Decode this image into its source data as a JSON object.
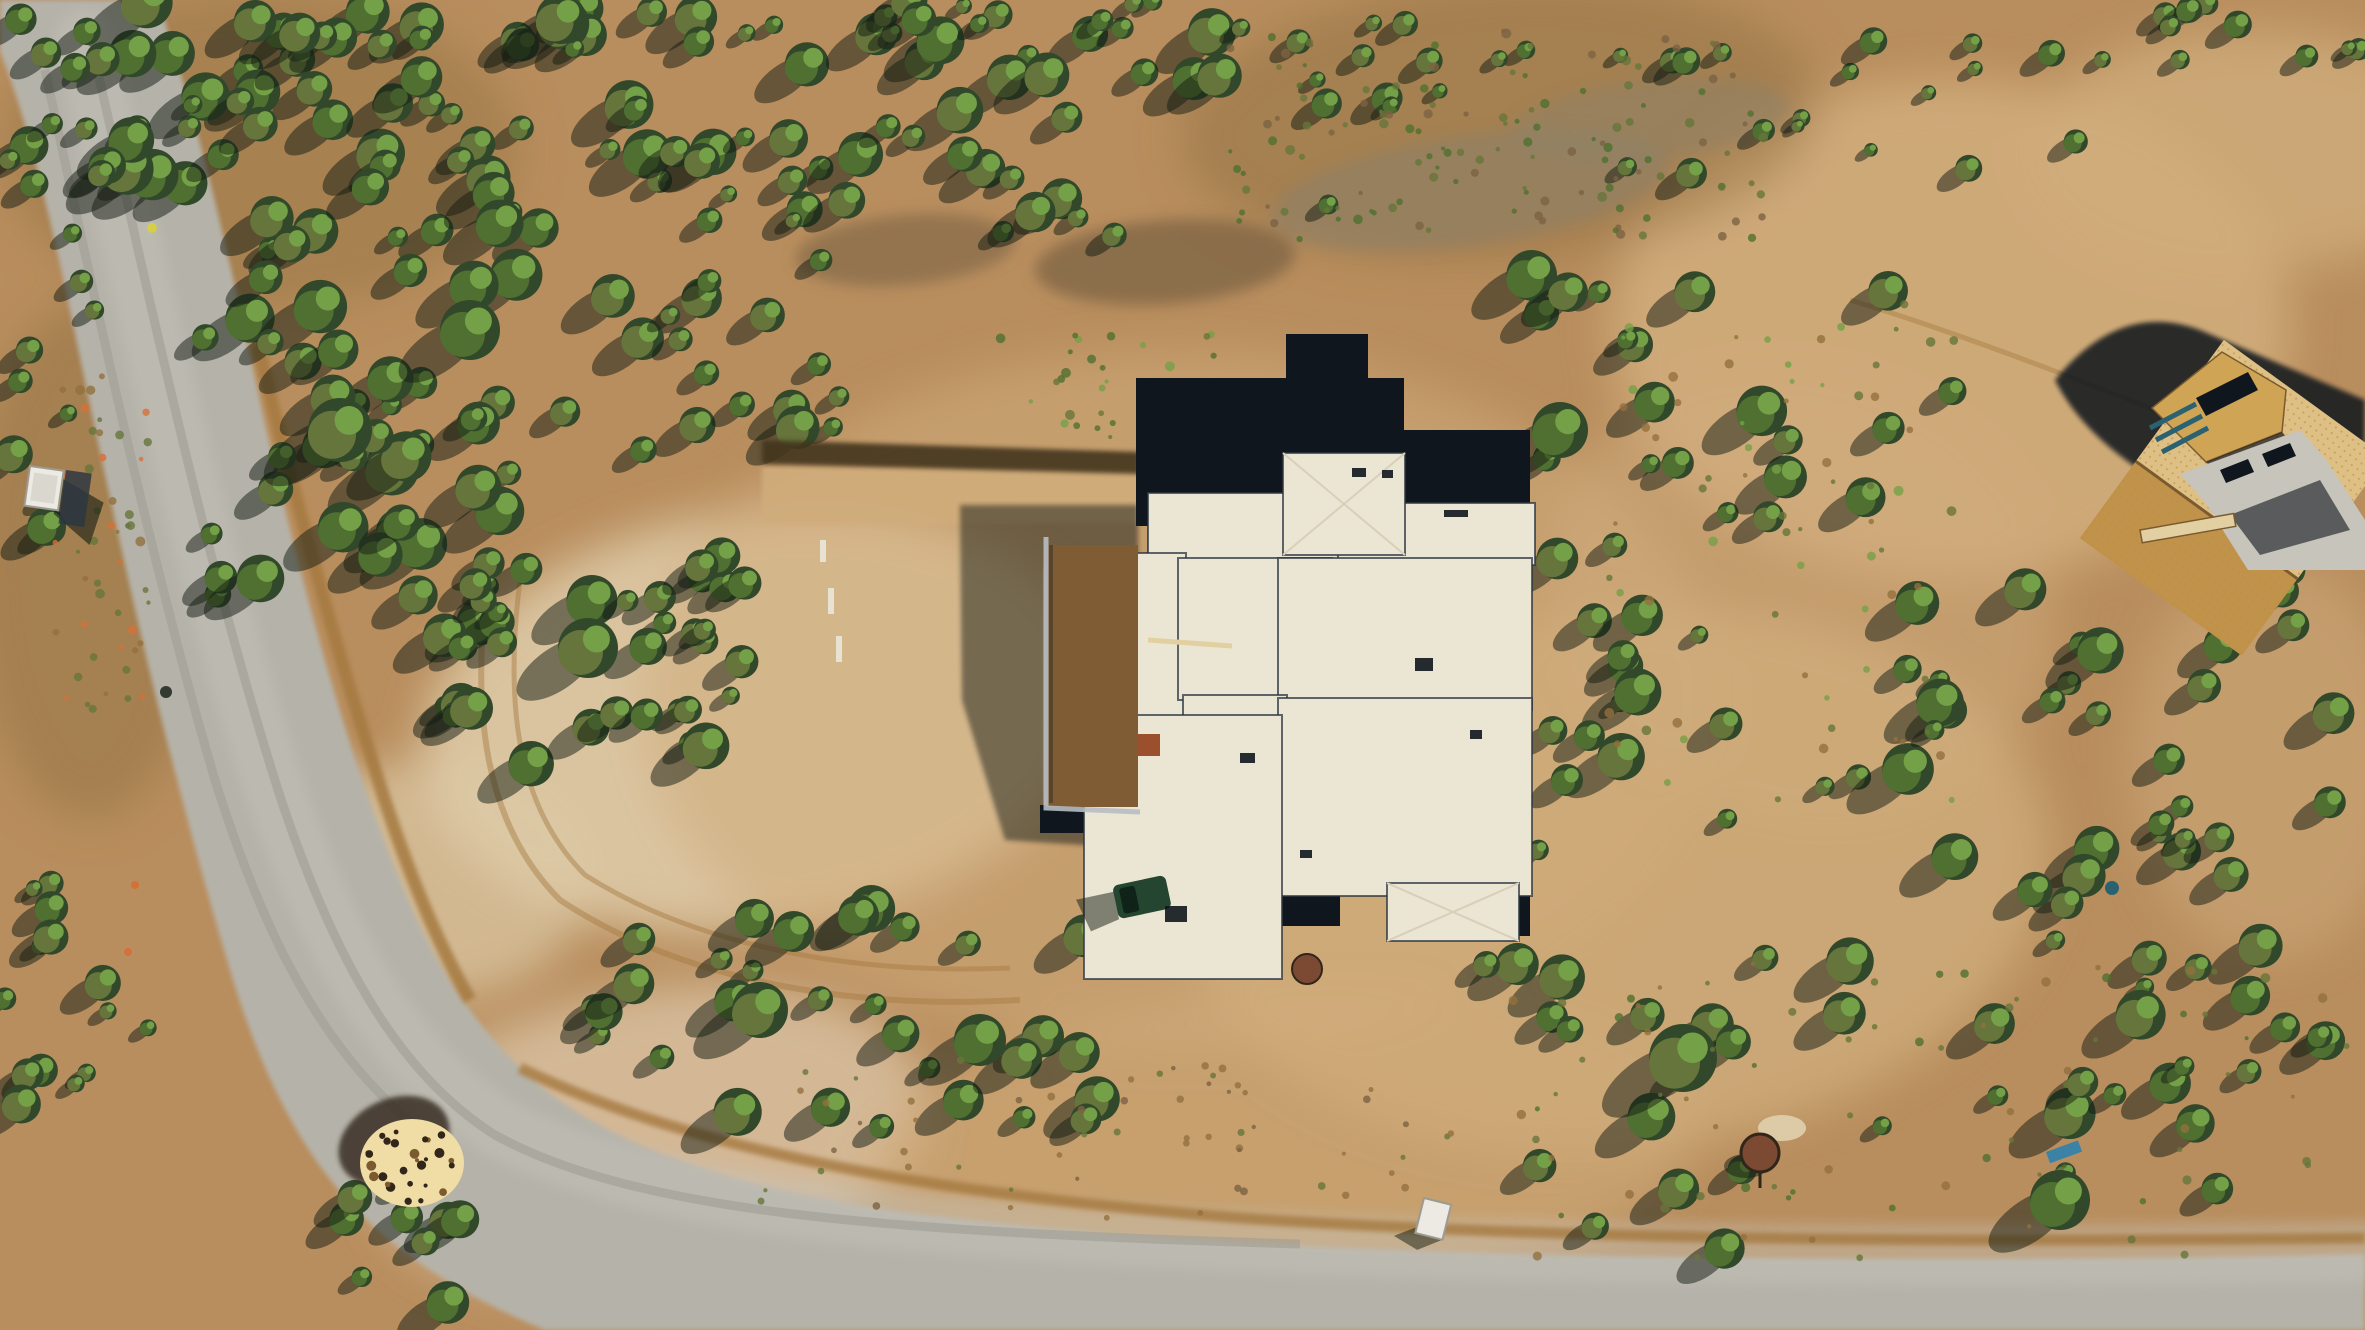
{
  "meta": {
    "kind": "aerial-drone-photograph",
    "description": "Overhead drone view of a flat-roof pueblo-style house under construction on a graded dirt pad, surrounded by juniper scrubland, with a gravel road curving along the left and bottom, a second wood-framed house at top right, a woodpile at the road bend, and a round stock tank among trees at lower right."
  },
  "palette": {
    "ground_base": "#b98e5e",
    "ground_light": "#d0ac7c",
    "ground_pale": "#ddcaa6",
    "ground_pink": "#d8c0a0",
    "ground_brown": "#92703f",
    "berm": "#a5793f",
    "road_gray": "#b5b2a9",
    "road_light": "#c6c3ba",
    "road_track": "#9d9a92",
    "green_dark": "#31492a",
    "green_mid": "#4f7030",
    "green_olive": "#66753b",
    "green_bright": "#74a047",
    "shadow": "#131c12",
    "debris_gray": "#8d8168",
    "debris_brown": "#7c6344",
    "house_white": "#ebe5d3",
    "house_hip": "#d8cfb8",
    "membrane_black": "#10161d",
    "parapet": "#2e3742",
    "courtyard_dirt": "#7f5c34",
    "wall_gray": "#b7bcc4",
    "mulch": "#42351f",
    "rust": "#7c4a33",
    "rust_square": "#9c4f2c",
    "osb": "#cfa455",
    "osb_dark": "#c0924a",
    "osb_deck": "#dfc084",
    "osb_dot": "#b5904c",
    "concrete": "#c7c4bb",
    "teal_boards": "#2b6272",
    "truck_green": "#24452f",
    "truck_glass": "#0f2318",
    "white_box": "#eceae2",
    "wood_light": "#f0dca5",
    "wood_dark": "#7a5a2e",
    "wood_black": "#30261a",
    "stake_white": "#e8e2d2",
    "plank_tan": "#e2d0a2",
    "tarp_blue": "#2f7fae",
    "marker_yellow": "#d7d23e",
    "marker_orange": "#d4703a"
  },
  "labels": {
    "main_house": "flat-roof house under construction",
    "framed_house": "wood-framed house under construction",
    "road": "gravel road",
    "woodpile": "woodpile",
    "stock_tank": "round stock tank",
    "porta_potty_top": "portable toilet beside road",
    "porta_potty_bottom": "portable toilet near trees",
    "vehicle": "utility vehicle",
    "courtyard": "walled dirt courtyard",
    "driveway": "graded driveway strip",
    "vegetation": "juniper and pinon scrub",
    "terrain": "high-desert dirt terrain"
  },
  "ground_patches": [
    {
      "cx": 760,
      "cy": 720,
      "rx": 340,
      "ry": 210,
      "fill": "ground_pale",
      "opacity": 0.9,
      "rot": -8
    },
    {
      "cx": 1180,
      "cy": 700,
      "rx": 540,
      "ry": 350,
      "fill": "ground_light",
      "opacity": 0.55,
      "rot": 0
    },
    {
      "cx": 1620,
      "cy": 880,
      "rx": 430,
      "ry": 270,
      "fill": "ground_light",
      "opacity": 0.8,
      "rot": -6
    },
    {
      "cx": 1950,
      "cy": 330,
      "rx": 340,
      "ry": 250,
      "fill": "ground_light",
      "opacity": 0.9,
      "rot": 0
    },
    {
      "cx": 2250,
      "cy": 150,
      "rx": 220,
      "ry": 120,
      "fill": "ground_light",
      "opacity": 0.8,
      "rot": 0
    },
    {
      "cx": 650,
      "cy": 1140,
      "rx": 280,
      "ry": 150,
      "fill": "ground_pink",
      "opacity": 0.85,
      "rot": -10
    },
    {
      "cx": 260,
      "cy": 150,
      "rx": 260,
      "ry": 160,
      "fill": "ground_brown",
      "opacity": 0.45,
      "rot": 0
    },
    {
      "cx": 1500,
      "cy": 120,
      "rx": 320,
      "ry": 140,
      "fill": "ground_brown",
      "opacity": 0.5,
      "rot": -4
    },
    {
      "cx": 90,
      "cy": 560,
      "rx": 120,
      "ry": 260,
      "fill": "ground_brown",
      "opacity": 0.5,
      "rot": 0
    },
    {
      "cx": 1800,
      "cy": 600,
      "rx": 260,
      "ry": 220,
      "fill": "ground_light",
      "opacity": 0.5,
      "rot": 20
    },
    {
      "cx": 1280,
      "cy": 1150,
      "rx": 420,
      "ry": 160,
      "fill": "ground_light",
      "opacity": 0.6,
      "rot": -4
    },
    {
      "cx": 430,
      "cy": 880,
      "rx": 160,
      "ry": 120,
      "fill": "ground_pale",
      "opacity": 0.7,
      "rot": 0
    },
    {
      "cx": 2270,
      "cy": 760,
      "rx": 140,
      "ry": 200,
      "fill": "ground_light",
      "opacity": 0.5,
      "rot": 0
    }
  ],
  "debris_patches": [
    {
      "cx": 1165,
      "cy": 262,
      "rx": 130,
      "ry": 42,
      "fill": "debris_brown",
      "opacity": 0.75,
      "rot": -4
    },
    {
      "cx": 1470,
      "cy": 190,
      "rx": 200,
      "ry": 55,
      "fill": "debris_gray",
      "opacity": 0.6,
      "rot": -8
    },
    {
      "cx": 1650,
      "cy": 120,
      "rx": 140,
      "ry": 40,
      "fill": "debris_gray",
      "opacity": 0.5,
      "rot": -6
    },
    {
      "cx": 905,
      "cy": 250,
      "rx": 110,
      "ry": 35,
      "fill": "debris_brown",
      "opacity": 0.6,
      "rot": -5
    }
  ],
  "vegetation": {
    "regions": [
      {
        "x": 115,
        "y": 0,
        "w": 555,
        "h": 250,
        "count": 64,
        "rmin": 9,
        "rmax": 26,
        "seed": 11
      },
      {
        "x": 670,
        "y": 0,
        "w": 560,
        "h": 235,
        "count": 52,
        "rmin": 8,
        "rmax": 24,
        "seed": 22
      },
      {
        "x": 1235,
        "y": 0,
        "w": 515,
        "h": 205,
        "count": 20,
        "rmin": 7,
        "rmax": 18,
        "seed": 33
      },
      {
        "x": 0,
        "y": 0,
        "w": 115,
        "h": 540,
        "count": 22,
        "rmin": 8,
        "rmax": 20,
        "seed": 44
      },
      {
        "x": 195,
        "y": 265,
        "w": 420,
        "h": 360,
        "count": 46,
        "rmin": 10,
        "rmax": 28,
        "seed": 55
      },
      {
        "x": 420,
        "y": 555,
        "w": 300,
        "h": 215,
        "count": 24,
        "rmin": 10,
        "rmax": 26,
        "seed": 66
      },
      {
        "x": 620,
        "y": 555,
        "w": 150,
        "h": 160,
        "count": 10,
        "rmin": 9,
        "rmax": 22,
        "seed": 77
      },
      {
        "x": 0,
        "y": 860,
        "w": 150,
        "h": 330,
        "count": 14,
        "rmin": 8,
        "rmax": 20,
        "seed": 88
      },
      {
        "x": 300,
        "y": 1180,
        "w": 170,
        "h": 150,
        "count": 9,
        "rmin": 10,
        "rmax": 22,
        "seed": 99
      },
      {
        "x": 560,
        "y": 900,
        "w": 580,
        "h": 230,
        "count": 30,
        "rmin": 9,
        "rmax": 24,
        "seed": 110
      },
      {
        "x": 1530,
        "y": 260,
        "w": 440,
        "h": 560,
        "count": 42,
        "rmin": 9,
        "rmax": 26,
        "seed": 121
      },
      {
        "x": 1950,
        "y": 570,
        "w": 415,
        "h": 450,
        "count": 30,
        "rmin": 9,
        "rmax": 24,
        "seed": 132
      },
      {
        "x": 1450,
        "y": 950,
        "w": 900,
        "h": 300,
        "count": 36,
        "rmin": 9,
        "rmax": 26,
        "seed": 143
      },
      {
        "x": 1380,
        "y": 690,
        "w": 220,
        "h": 210,
        "count": 12,
        "rmin": 8,
        "rmax": 20,
        "seed": 154
      },
      {
        "x": 2080,
        "y": 0,
        "w": 285,
        "h": 60,
        "count": 10,
        "rmin": 6,
        "rmax": 14,
        "seed": 165
      },
      {
        "x": 1750,
        "y": 40,
        "w": 330,
        "h": 130,
        "count": 12,
        "rmin": 6,
        "rmax": 14,
        "seed": 176
      },
      {
        "x": 640,
        "y": 250,
        "w": 200,
        "h": 200,
        "count": 16,
        "rmin": 9,
        "rmax": 22,
        "seed": 187
      }
    ],
    "feature_trees": [
      {
        "x": 1683,
        "y": 1058,
        "r": 34
      },
      {
        "x": 588,
        "y": 648,
        "r": 30
      },
      {
        "x": 760,
        "y": 1010,
        "r": 28
      },
      {
        "x": 980,
        "y": 1040,
        "r": 26
      },
      {
        "x": 1560,
        "y": 430,
        "r": 28
      },
      {
        "x": 340,
        "y": 430,
        "r": 32
      },
      {
        "x": 470,
        "y": 330,
        "r": 30
      },
      {
        "x": 2060,
        "y": 1200,
        "r": 30
      }
    ]
  },
  "dot_regions": [
    {
      "x": 1230,
      "y": 30,
      "w": 540,
      "h": 210,
      "count": 130,
      "rmin": 2,
      "rmax": 5,
      "seed": 201,
      "colors": [
        "green_olive",
        "debris_brown",
        "green_mid"
      ]
    },
    {
      "x": 1500,
      "y": 960,
      "w": 860,
      "h": 300,
      "count": 80,
      "rmin": 2,
      "rmax": 5,
      "seed": 202,
      "colors": [
        "green_olive",
        "ground_brown",
        "green_mid"
      ]
    },
    {
      "x": 55,
      "y": 370,
      "w": 95,
      "h": 340,
      "count": 50,
      "rmin": 2,
      "rmax": 5,
      "seed": 203,
      "colors": [
        "marker_orange",
        "ground_brown",
        "green_olive"
      ]
    },
    {
      "x": 1600,
      "y": 300,
      "w": 360,
      "h": 500,
      "count": 70,
      "rmin": 2,
      "rmax": 5,
      "seed": 204,
      "colors": [
        "green_olive",
        "ground_brown",
        "green_bright"
      ]
    },
    {
      "x": 760,
      "y": 1060,
      "w": 700,
      "h": 160,
      "count": 60,
      "rmin": 2,
      "rmax": 4,
      "seed": 205,
      "colors": [
        "ground_brown",
        "debris_brown",
        "green_olive"
      ]
    },
    {
      "x": 1000,
      "y": 330,
      "w": 220,
      "h": 110,
      "count": 30,
      "rmin": 2,
      "rmax": 5,
      "seed": 206,
      "colors": [
        "green_mid",
        "green_olive",
        "green_bright"
      ]
    }
  ],
  "woodpile": {
    "cx": 412,
    "cy": 1163,
    "rx": 52,
    "ry": 44,
    "dots": 36,
    "seed": 301
  }
}
